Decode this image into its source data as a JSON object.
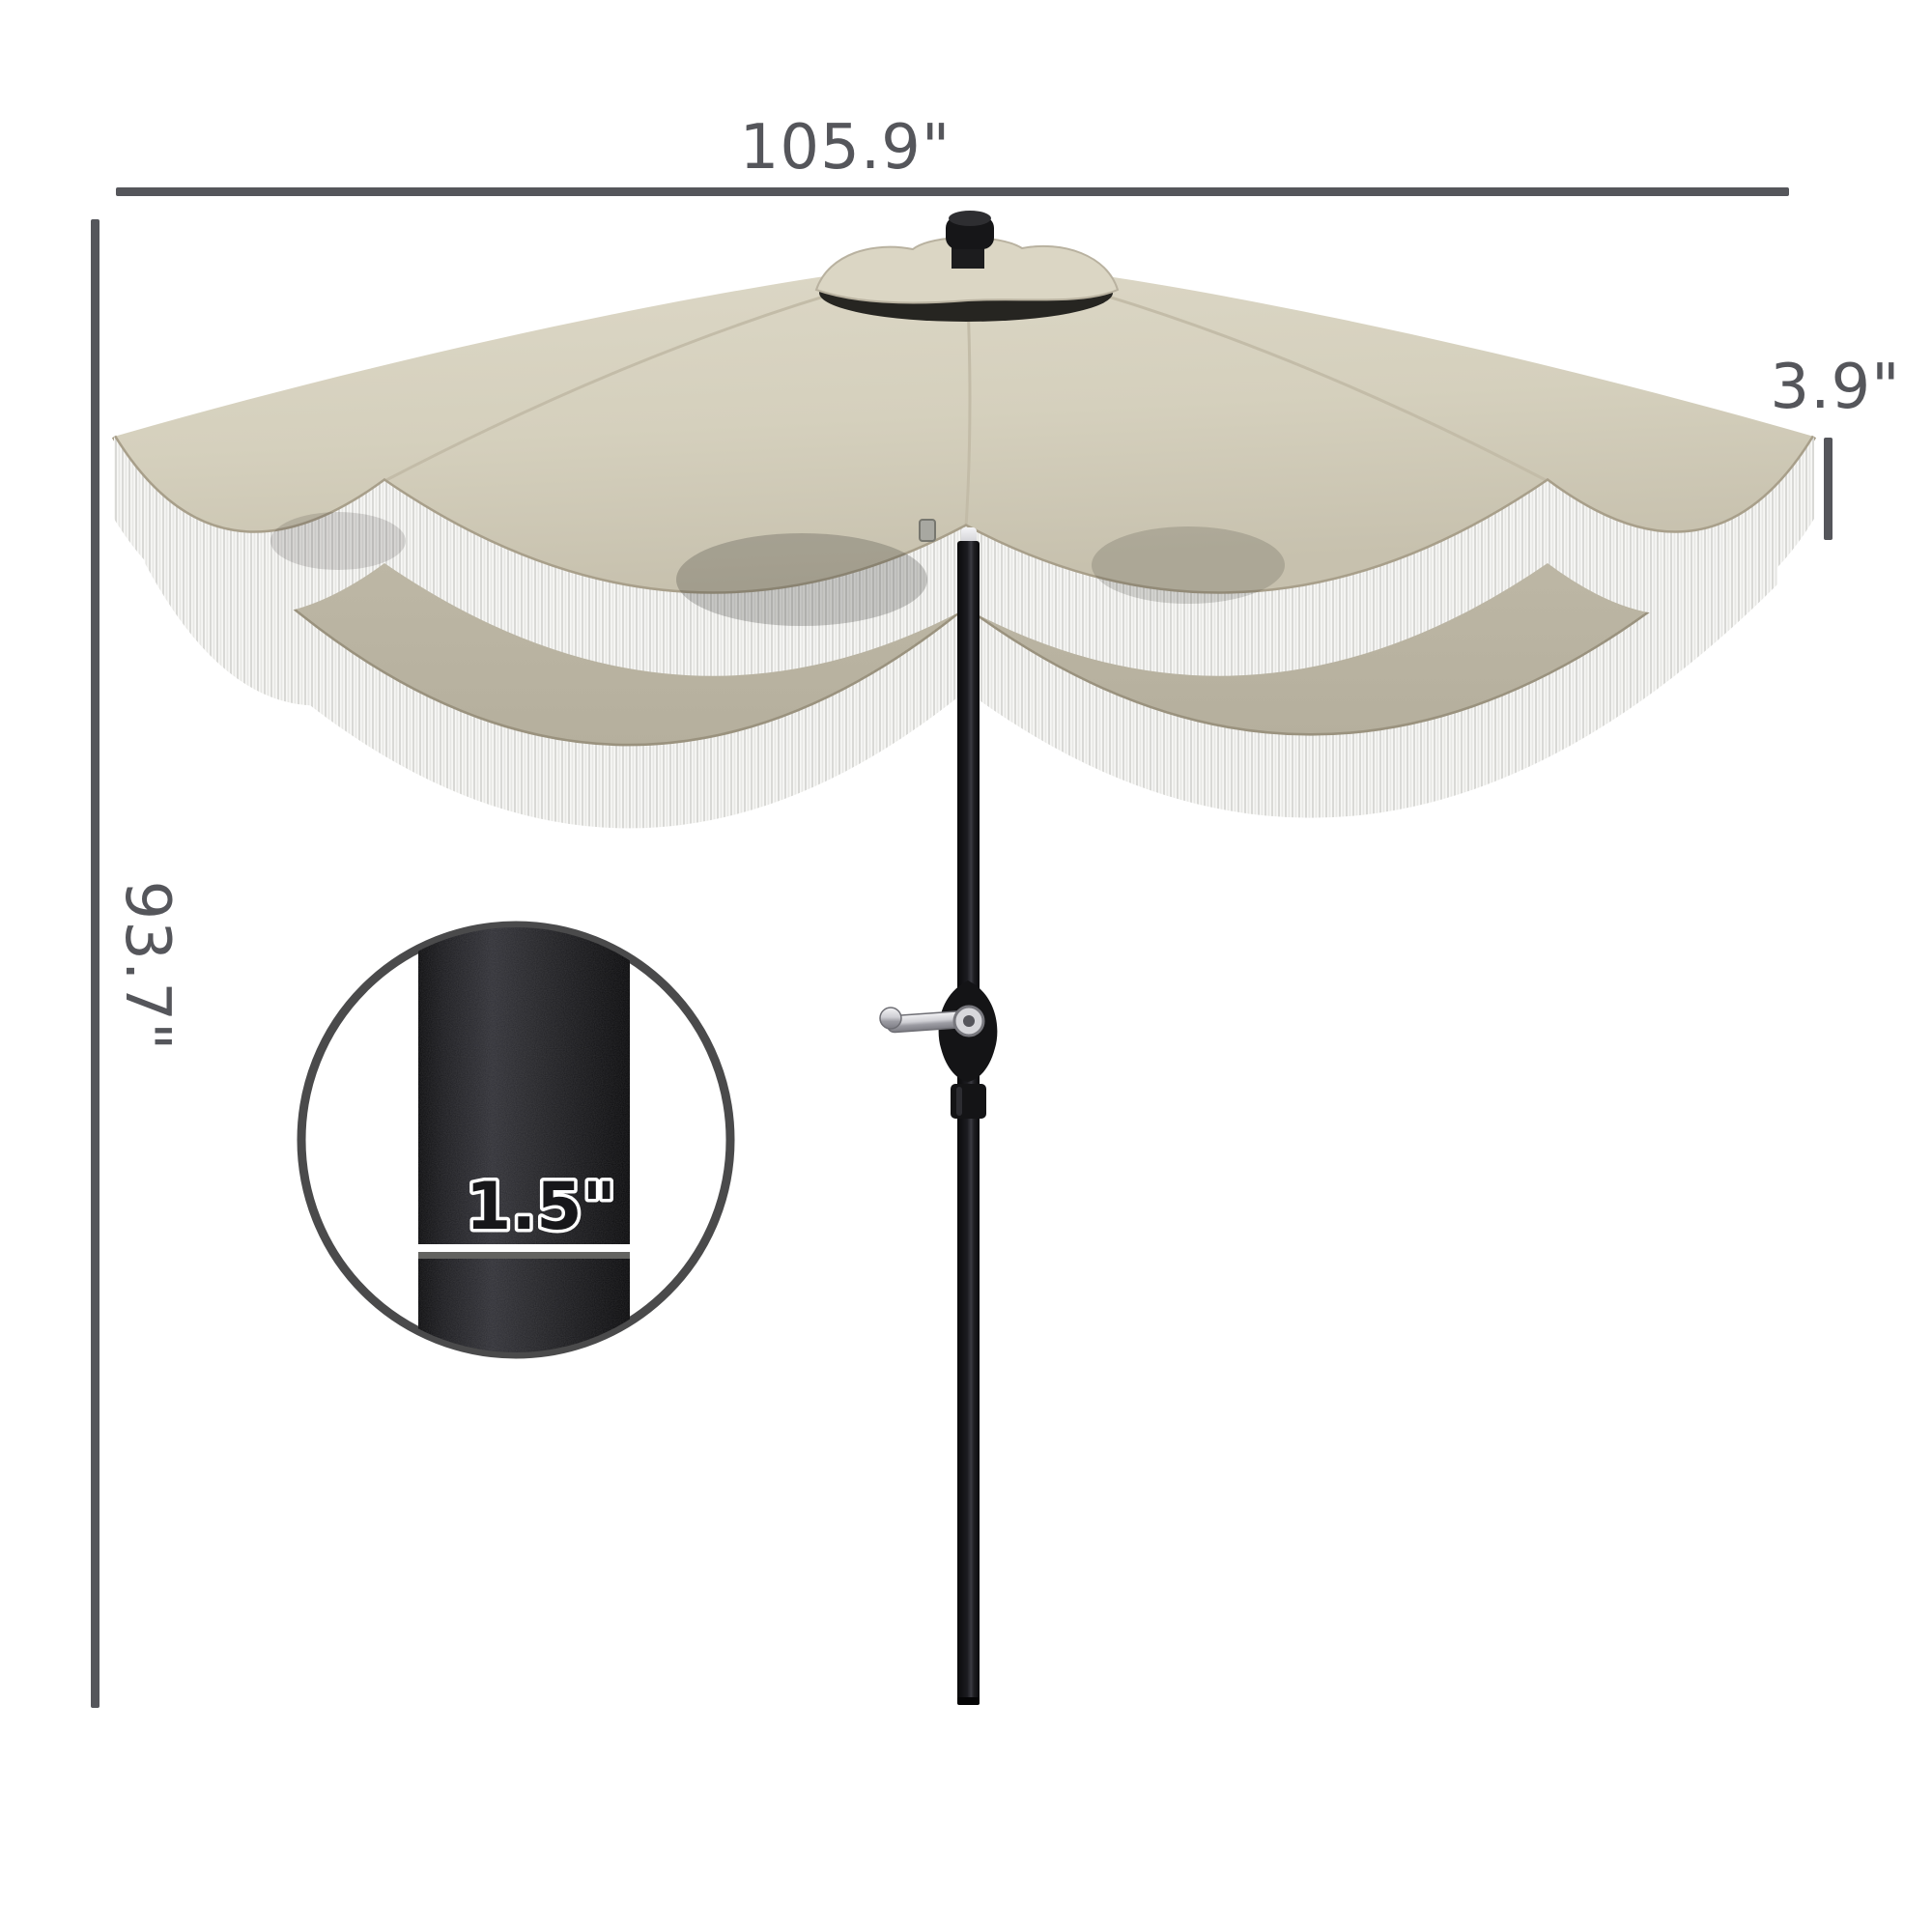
{
  "dimensions": {
    "canopy_width": "105.9\"",
    "overall_height": "93.7\"",
    "valance_height": "3.9\"",
    "pole_diameter": "1.5\""
  },
  "colors": {
    "annotation": "#55565b",
    "canopy_light": "#d9d4c2",
    "canopy_mid": "#c5bfad",
    "canopy_dark": "#b7b19f",
    "fringe_white": "#f6f6f4",
    "pole_black": "#17171a",
    "background": "#ffffff"
  }
}
